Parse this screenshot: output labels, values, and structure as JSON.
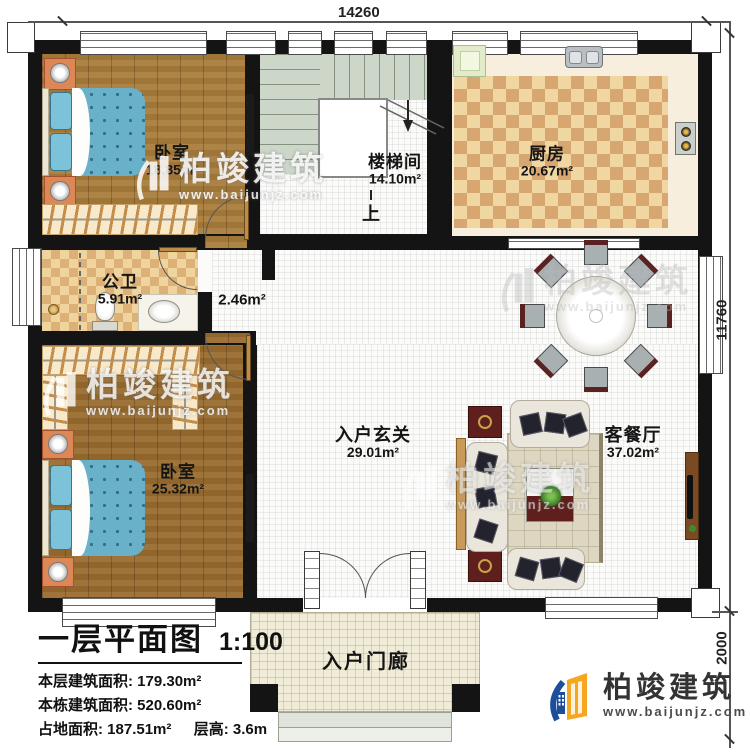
{
  "plan": {
    "dim_top": "14260",
    "dim_right": "11760",
    "dim_right_lower": "2000",
    "rooms": {
      "bedroom_top": {
        "name": "卧室",
        "area": "18.85m²"
      },
      "stairwell": {
        "name": "楼梯间",
        "area": "14.10m²",
        "direction": "上"
      },
      "kitchen": {
        "name": "厨房",
        "area": "20.67m²"
      },
      "bathroom": {
        "name": "公卫",
        "area": "5.91m²"
      },
      "vestibule": {
        "area": "2.46m²"
      },
      "bedroom_bottom": {
        "name": "卧室",
        "area": "25.32m²"
      },
      "foyer": {
        "name": "入户玄关",
        "area": "29.01m²"
      },
      "living_dining": {
        "name": "客餐厅",
        "area": "37.02m²"
      },
      "porch": {
        "name": "入户门廊"
      }
    }
  },
  "title_block": {
    "title": "一层平面图",
    "scale": "1:100",
    "floor_area": "本层建筑面积: 179.30m²",
    "building_area": "本栋建筑面积: 520.60m²",
    "footprint": "占地面积: 187.51m²",
    "storey_height": "层高: 3.6m"
  },
  "brand": {
    "name": "柏竣建筑",
    "website": "www.baijunjz.com"
  },
  "watermark": {
    "name": "柏竣建筑",
    "website": "www.baijunjz.com"
  },
  "colors": {
    "wall": "#141414",
    "wood": "#a5783a",
    "checker": "#d8a771",
    "logo_blue": "#1d4e9b",
    "logo_orange": "#f6a71f"
  }
}
